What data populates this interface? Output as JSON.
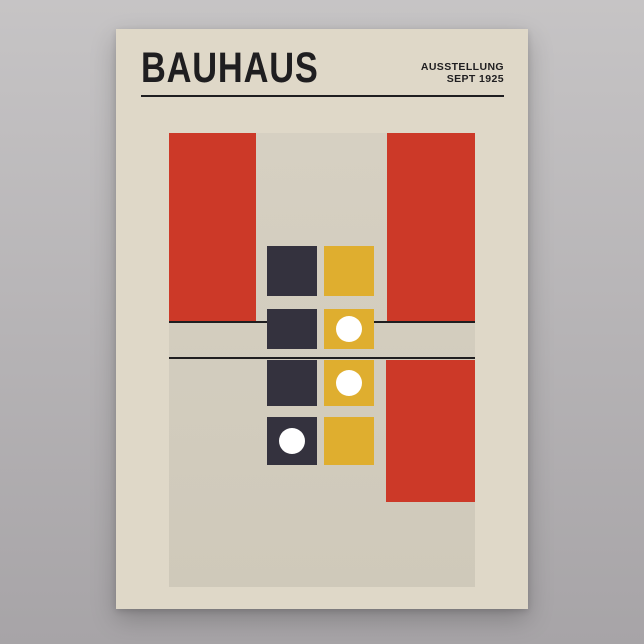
{
  "page": {
    "width": 644,
    "height": 644
  },
  "colors": {
    "page_top": "#c6c4c5",
    "page_bottom": "#a7a4a7",
    "poster_bg": "#dfd8c8",
    "panel_top": "#d6d0c2",
    "panel_bottom": "#cfc9ba",
    "red": "#cc3928",
    "navy": "#34323e",
    "yellow": "#dfae2f",
    "white": "#ffffff",
    "ink": "#1f1e20"
  },
  "poster": {
    "title": "BAUHAUS",
    "exhibition_label": "AUSSTELLUNG",
    "exhibition_date": "SEPT 1925"
  },
  "artwork": {
    "dot_diameter": 26,
    "shapes": [
      {
        "name": "red-block-left",
        "type": "rect",
        "x": 53,
        "y": 104,
        "w": 87,
        "h": 188,
        "color": "red",
        "dot": false
      },
      {
        "name": "red-block-right-upper",
        "type": "rect",
        "x": 271,
        "y": 104,
        "w": 88,
        "h": 188,
        "color": "red",
        "dot": false
      },
      {
        "name": "red-block-right-lower",
        "type": "rect",
        "x": 270,
        "y": 331,
        "w": 89,
        "h": 142,
        "color": "red",
        "dot": false
      },
      {
        "name": "divider-upper-left",
        "type": "line",
        "x": 53,
        "y": 292,
        "w": 99,
        "h": 2,
        "color": "ink",
        "dot": false
      },
      {
        "name": "divider-upper-right",
        "type": "line",
        "x": 258,
        "y": 292,
        "w": 101,
        "h": 2,
        "color": "ink",
        "dot": false
      },
      {
        "name": "divider-lower",
        "type": "line",
        "x": 53,
        "y": 328,
        "w": 306,
        "h": 2,
        "color": "ink",
        "dot": false
      },
      {
        "name": "square-navy-row1",
        "type": "square",
        "x": 151,
        "y": 217,
        "w": 50,
        "h": 50,
        "color": "navy",
        "dot": false
      },
      {
        "name": "square-yellow-row1",
        "type": "square",
        "x": 208,
        "y": 217,
        "w": 50,
        "h": 50,
        "color": "yellow",
        "dot": false
      },
      {
        "name": "square-navy-row2",
        "type": "square",
        "x": 151,
        "y": 280,
        "w": 50,
        "h": 40,
        "color": "navy",
        "dot": false
      },
      {
        "name": "square-yellow-row2",
        "type": "square",
        "x": 208,
        "y": 280,
        "w": 50,
        "h": 40,
        "color": "yellow",
        "dot": true
      },
      {
        "name": "square-navy-row3",
        "type": "square",
        "x": 151,
        "y": 331,
        "w": 50,
        "h": 46,
        "color": "navy",
        "dot": false
      },
      {
        "name": "square-yellow-row3",
        "type": "square",
        "x": 208,
        "y": 331,
        "w": 50,
        "h": 46,
        "color": "yellow",
        "dot": true
      },
      {
        "name": "square-navy-row4",
        "type": "square",
        "x": 151,
        "y": 388,
        "w": 50,
        "h": 48,
        "color": "navy",
        "dot": true
      },
      {
        "name": "square-yellow-row4",
        "type": "square",
        "x": 208,
        "y": 388,
        "w": 50,
        "h": 48,
        "color": "yellow",
        "dot": false
      }
    ]
  }
}
